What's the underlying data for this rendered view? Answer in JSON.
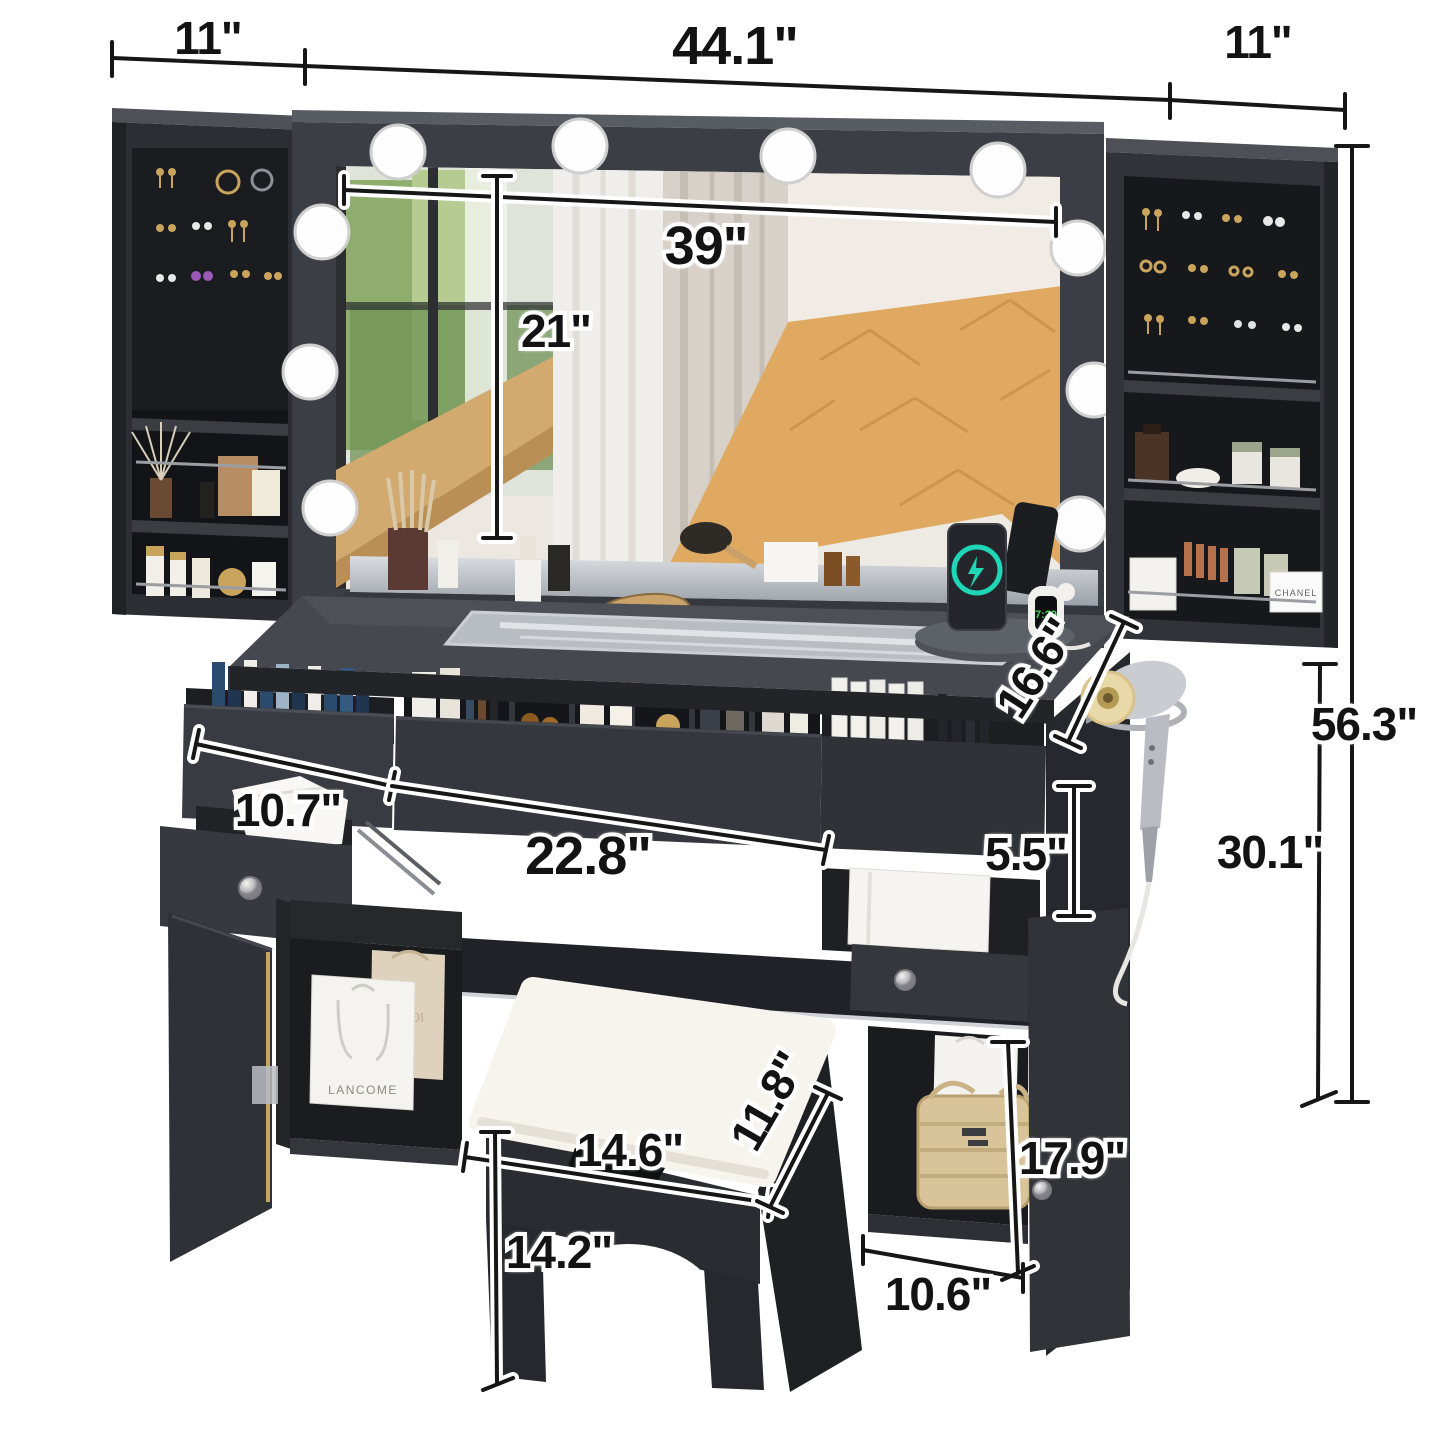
{
  "product": {
    "title": "Black Vanity Desk Set with Hollywood Lighted Mirror, Side Jewelry Cabinets, Charging Station and Storage Stool",
    "bulb_count": 10
  },
  "dims": {
    "left_cabinet_width": "11\"",
    "overall_width": "44.1\"",
    "right_cabinet_width": "11\"",
    "mirror_width": "39\"",
    "mirror_height": "21\"",
    "desktop_depth": "16.6\"",
    "overall_height": "56.3\"",
    "desktop_height": "30.1\"",
    "left_drawer_width": "10.7\"",
    "middle_drawer_width": "22.8\"",
    "side_drawer_height": "5.5\"",
    "side_cubby_height": "17.9\"",
    "side_cubby_width": "10.6\"",
    "stool_width": "14.6\"",
    "stool_depth": "11.8\"",
    "stool_height": "14.2\""
  },
  "labels": {
    "bag_brand": "LANCOME",
    "gold_bag_brand": "KOI",
    "box_brand": "CHANEL",
    "watch_time": "7:29"
  },
  "colors": {
    "furniture_dark": "#2b2d31",
    "furniture_mid": "#3a3d43",
    "interior_black": "#17181b",
    "accent_teal": "#1fd6b6",
    "watch_green": "#3ddc5a",
    "gold": "#c9a45c",
    "cushion_white": "#f7f4ee",
    "wood_floor": "#dca75f"
  }
}
